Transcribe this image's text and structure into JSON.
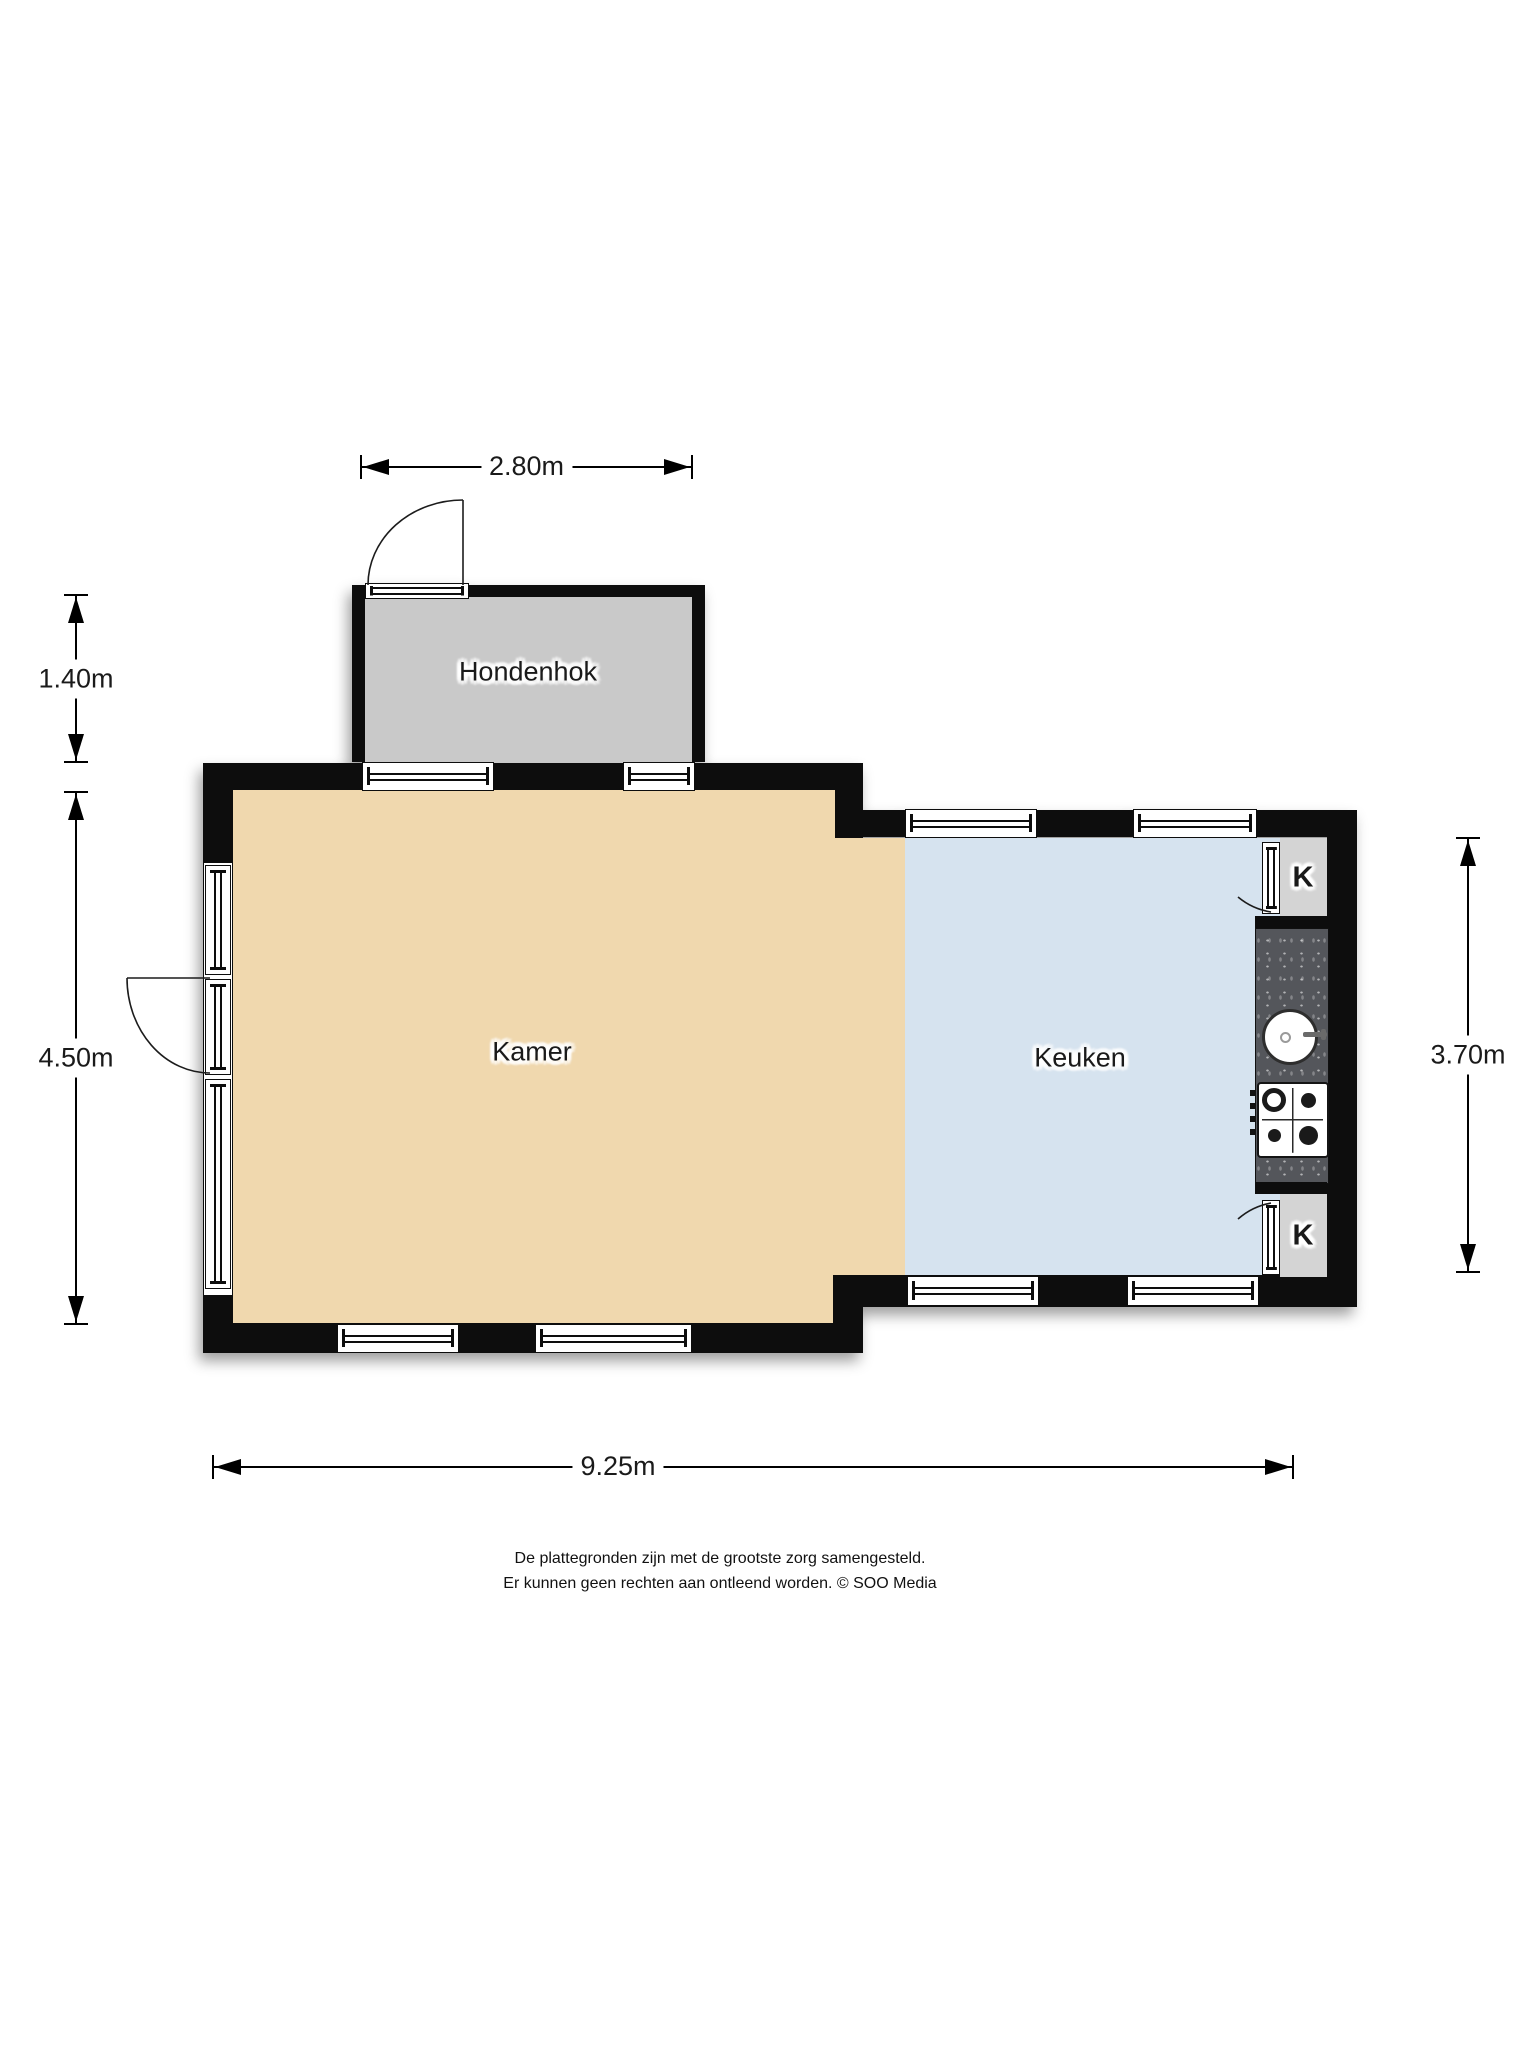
{
  "plan": {
    "title": "floor plan",
    "rooms": [
      {
        "id": "hondenhok",
        "label": "Hondenhok",
        "color": "#c9c9c9"
      },
      {
        "id": "kamer",
        "label": "Kamer",
        "color": "#f0d8ae"
      },
      {
        "id": "keuken",
        "label": "Keuken",
        "color": "#d6e3ef"
      }
    ],
    "closets": [
      {
        "label": "K"
      },
      {
        "label": "K"
      }
    ],
    "colors": {
      "wall": "#0d0d0d",
      "counter": "#54565b",
      "closet": "#d4d4d4"
    }
  },
  "dimensions": [
    {
      "id": "hondenhok-width",
      "label": "2.80m"
    },
    {
      "id": "hondenhok-height",
      "label": "1.40m"
    },
    {
      "id": "kamer-height",
      "label": "4.50m"
    },
    {
      "id": "keuken-height",
      "label": "3.70m"
    },
    {
      "id": "total-width",
      "label": "9.25m"
    }
  ],
  "footer": {
    "line1": "De plattegronden zijn met de grootste zorg samengesteld.",
    "line2": "Er kunnen geen rechten aan ontleend worden. © SOO Media"
  }
}
